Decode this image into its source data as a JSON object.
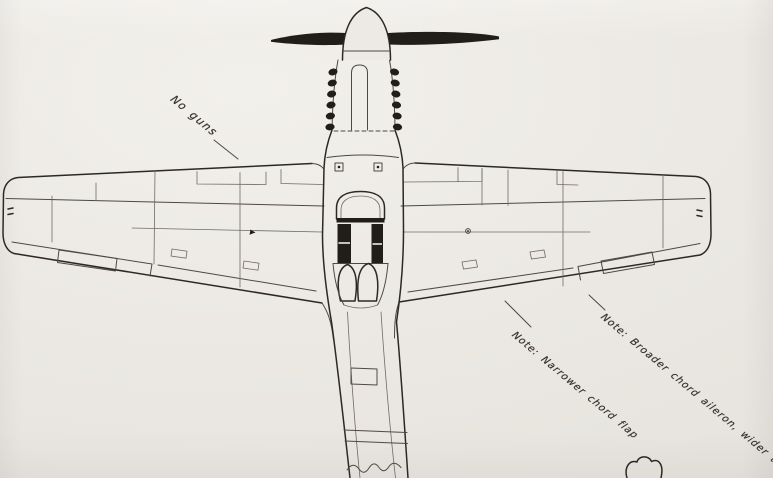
{
  "page": {
    "description": "Scanned hand-drawn plan view (top view) of a single-engine propeller fighter aircraft on paper, nose at top, rear fuselage running off the bottom edge"
  },
  "annotations": {
    "no_guns": {
      "text": "No guns"
    },
    "flap_note": {
      "text": "Note: Narrower chord flap"
    },
    "aileron_note": {
      "text": "Note: Broader chord aileron, wider trim tab"
    }
  },
  "colors": {
    "paper": "#ece9e4",
    "pencil_line": "#4d4841",
    "heavy_line": "#2c2823",
    "dark_fill": "#211e1a",
    "handwriting_ink": "#38332c"
  }
}
